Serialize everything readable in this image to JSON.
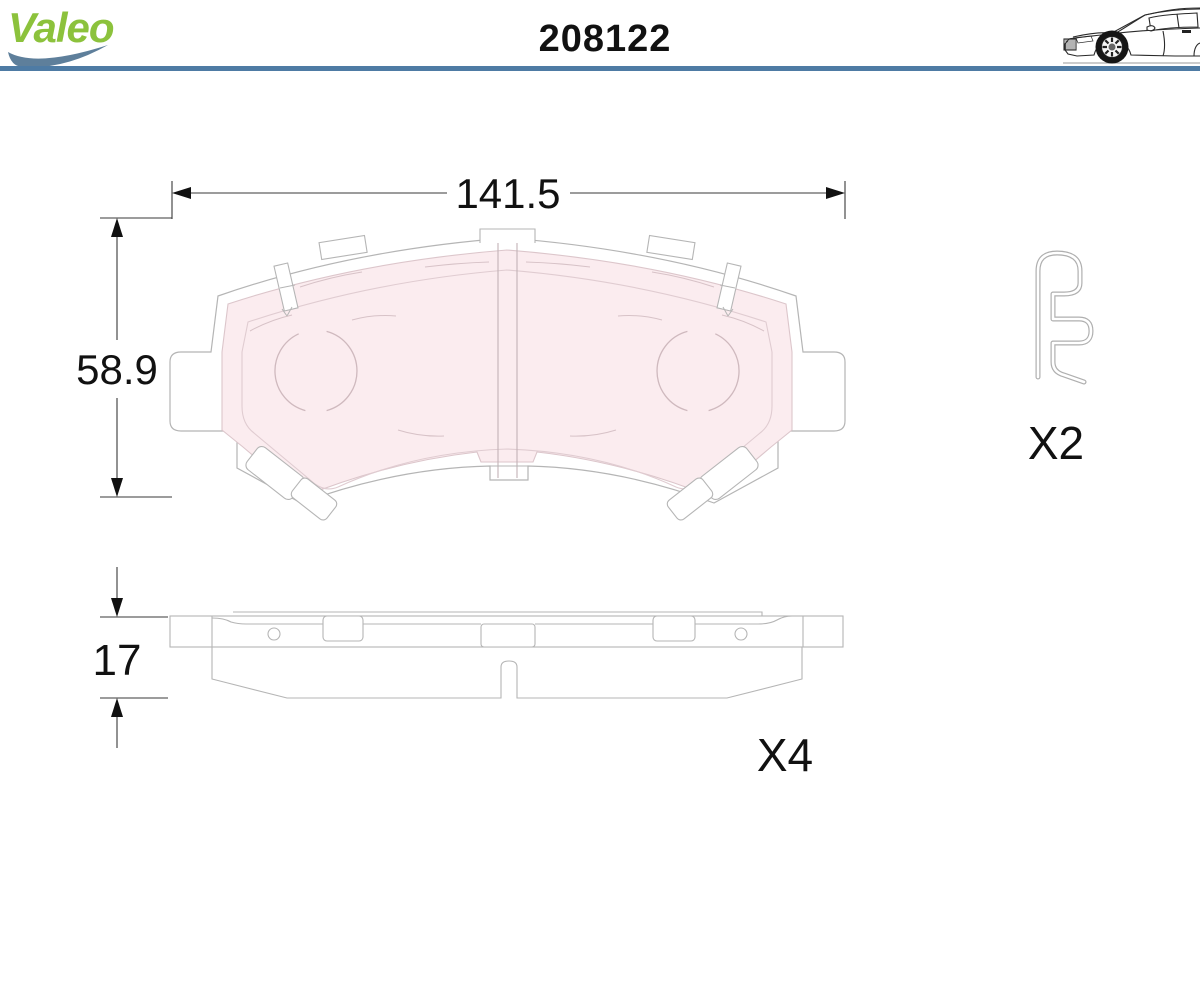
{
  "header": {
    "brand": "Valeo",
    "part_number": "208122"
  },
  "front_view": {
    "width_mm": "141.5",
    "height_mm": "58.9"
  },
  "side_view": {
    "thickness_mm": "17",
    "quantity": "X4"
  },
  "accessory_clip": {
    "quantity": "X2"
  },
  "icons": {
    "logo_swoosh": "brand-swoosh-icon",
    "car": "car-side-lineart-icon",
    "clip": "pad-retaining-spring-clip"
  },
  "colors": {
    "brand_green": "#8CC23C",
    "swoosh_blue": "#5E7F9B",
    "rule_blue": "#4E7BA4",
    "pad_fill_pink": "#FBECEF",
    "pad_line_pink": "#DCC6CB",
    "drawing_line_gray": "#B5B5B5",
    "dimension_black": "#111111"
  }
}
